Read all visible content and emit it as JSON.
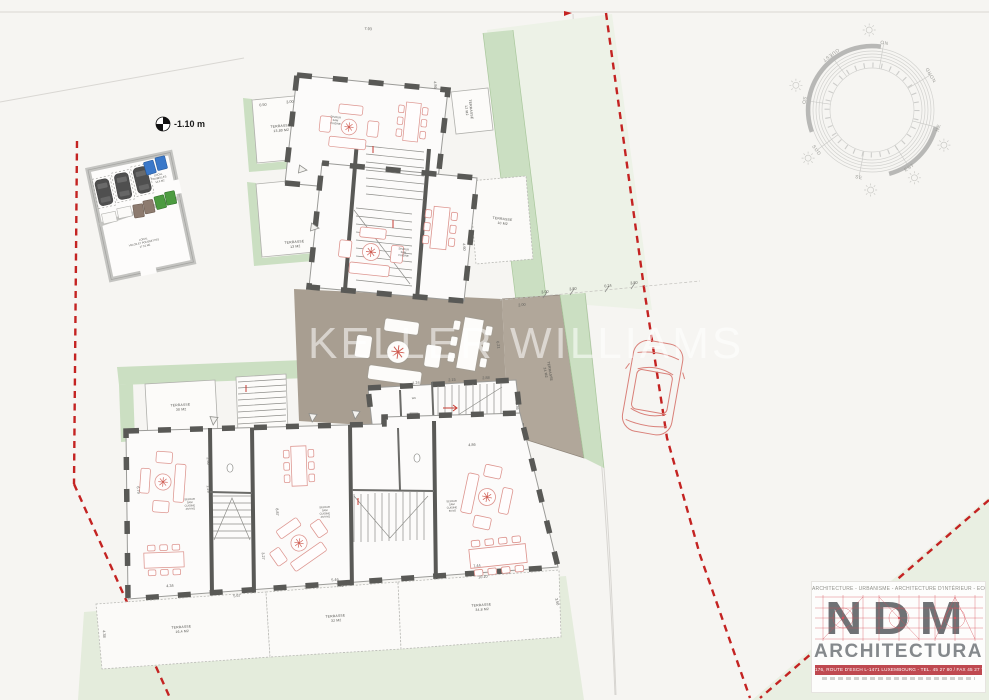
{
  "meta": {
    "watermark": "KELLER WILLIAMS",
    "level_marker": "-1.10 m"
  },
  "compass": {
    "n": "NORD",
    "ne": "NE",
    "e": "EST",
    "se": "SE",
    "s": "SUD",
    "so": "SO",
    "o": "OUEST",
    "no": "NO"
  },
  "annex": {
    "poubelles": {
      "l1": "LOCAL",
      "l2": "POUBELLES",
      "area": "14,9 M2"
    },
    "velos": {
      "l1": "LOCAL",
      "l2": "VELOS ET POUSSETTES",
      "area": "17,51 M2"
    }
  },
  "rooms": {
    "sejour_a": {
      "l1": "SEJOUR",
      "l2": "SAM",
      "l3": "CUISINE"
    },
    "sejour_b": {
      "l1": "SEJOUR",
      "l2": "SAM",
      "l3": "CUISINE"
    },
    "sejour_1": {
      "l1": "SEJOUR",
      "l2": "SAM",
      "l3": "CUISINE",
      "area": "49,9 M2"
    },
    "sejour_2": {
      "l1": "SEJOUR",
      "l2": "SAM",
      "l3": "CUISINE",
      "area": "49,9 M2"
    },
    "sejour_3": {
      "l1": "SEJOUR",
      "l2": "SAM",
      "l3": "CUISINE",
      "area": "60 M2"
    },
    "wc": "WC"
  },
  "terraces": {
    "t1": {
      "name": "TERRASSE",
      "area": "13,80 M2"
    },
    "t2": {
      "name": "TERRASSE",
      "area": "13 M2"
    },
    "t3": {
      "name": "TERRASSE",
      "area": "12 M2"
    },
    "t4": {
      "name": "TERRASSE",
      "area": "10 M2"
    },
    "t5": {
      "name": "TERRASSE",
      "area": "24 M2"
    },
    "t6": {
      "name": "TERRASSE",
      "area": "30 M2"
    },
    "t7": {
      "name": "TERRASSE",
      "area": "16,4 M2"
    },
    "t8": {
      "name": "TERRASSE",
      "area": "32 M2"
    },
    "t9": {
      "name": "TERRASSE",
      "area": "34,8 M2"
    }
  },
  "dims": {
    "d1": "7.93",
    "d2": "4.86",
    "d3": "0.50",
    "d4": "3.00",
    "d5": "3.00",
    "d6": "3.80",
    "d7": "0.24",
    "d8": "3.80",
    "d9": "2.00",
    "d10": "4.60",
    "d11": "6.21",
    "d12": "2.50",
    "d13": "1.29",
    "d14": "1.24",
    "d15": "2.15",
    "d16": "2.88",
    "d17": "2.36",
    "d18": "3.14",
    "d19": "6.79",
    "d20": "8.87",
    "d21": "4.86",
    "d22": "3.27",
    "d23": "2.35",
    "d24": "4.34",
    "d25": "5.46",
    "d26": "7.44",
    "d27": "5.67",
    "d28": "7.25",
    "d29": "10.10",
    "d30": "4.38",
    "d31": "3.50"
  },
  "logo": {
    "tagline": "ARCHITECTURE - URBANISME - ARCHITECTURE D'INTÉRIEUR - ECOLOGIE",
    "name": "NDM",
    "subname": "ARCHITECTURA",
    "address": "176, ROUTE D'ESCH L-1471 LUXEMBOURG - TEL. 45 27 80 / FAX 45 27 75"
  }
}
